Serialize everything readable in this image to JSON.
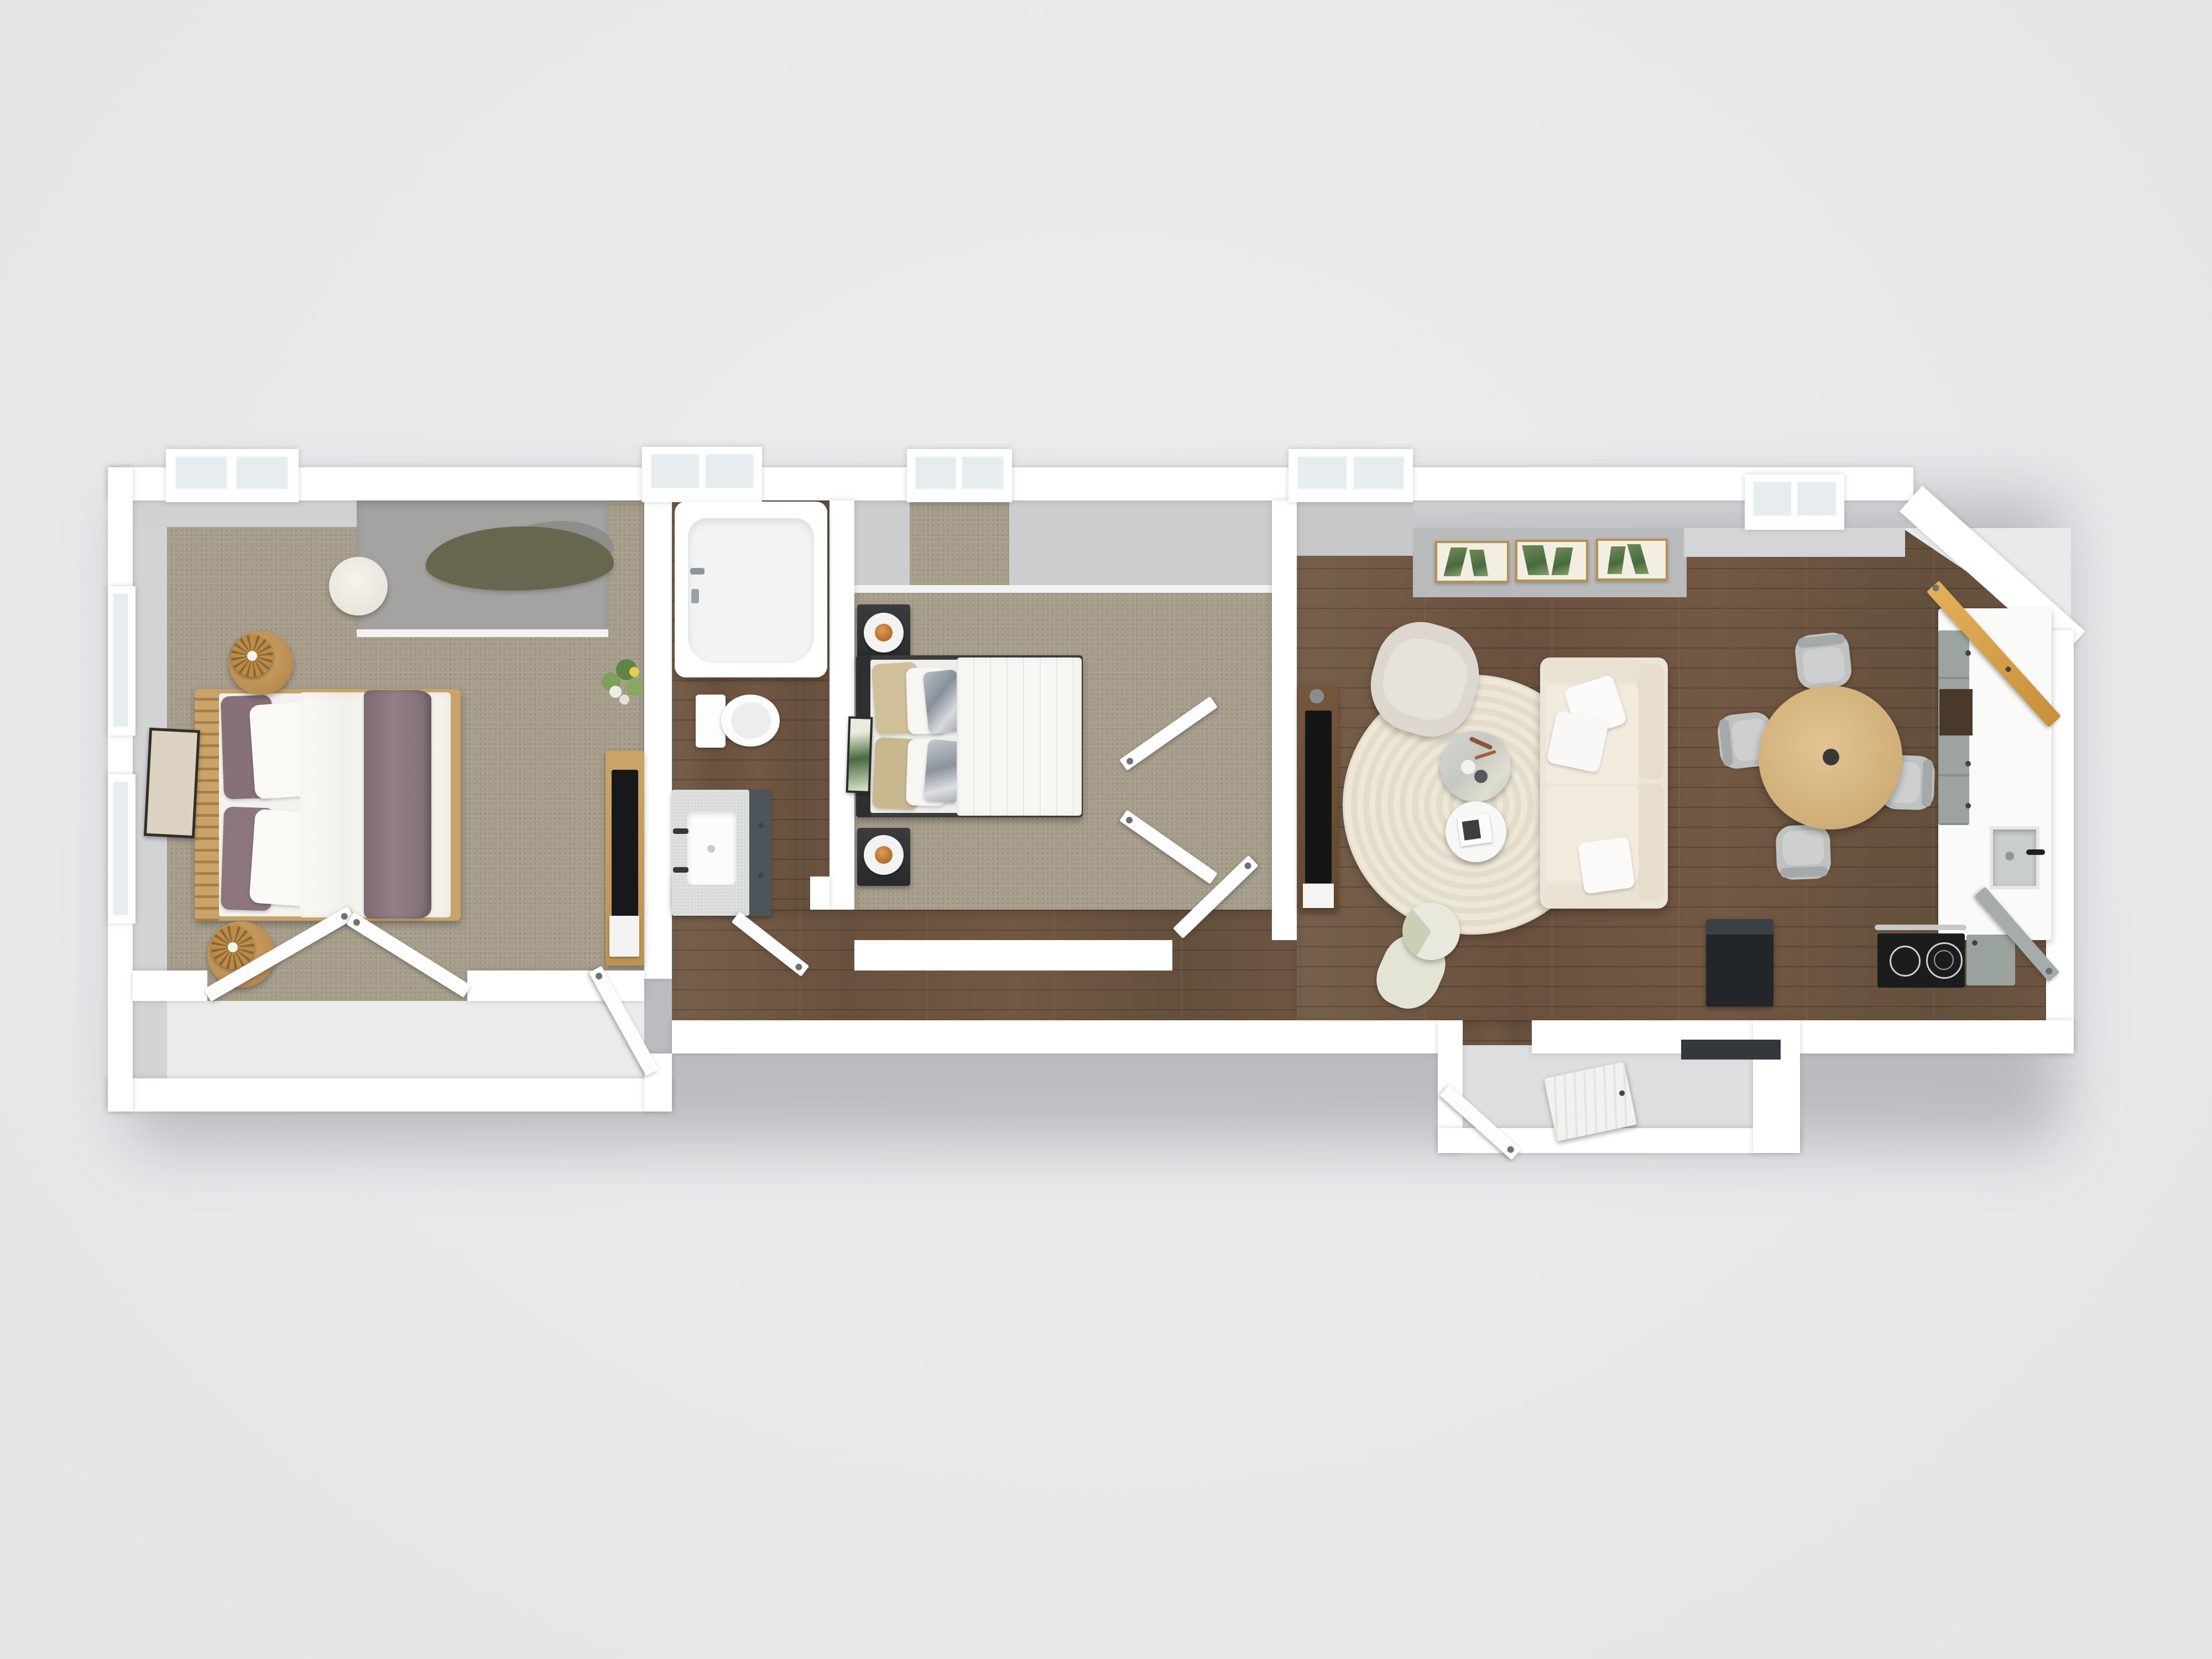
{
  "scene": {
    "description": "3D rendered top-down floor plan of a long, narrow two-bedroom apartment",
    "view": "top-down dollhouse render",
    "background_color": "#e9eaec",
    "wall_color": "#ffffff"
  },
  "rooms": [
    {
      "label": "Bedroom 1",
      "floor": "carpet",
      "items": [
        "oak double bed with white duvet and mauve throw",
        "two round oak nightstands with rattan lamps",
        "white round pouf",
        "organic olive-green rug in window nook",
        "leaning framed art",
        "oak dresser with TV, flowers and magazine",
        "closet with open double doors"
      ]
    },
    {
      "label": "Bathroom",
      "floor": "hardwood",
      "items": [
        "bathtub with chrome faucet",
        "toilet",
        "vanity with white sink and dark cabinet",
        "open door"
      ]
    },
    {
      "label": "Bedroom 2",
      "floor": "carpet",
      "items": [
        "black-frame double bed with quilted white duvet, khaki and marble pillows",
        "two black nightstands with bowl lamps",
        "leaning botanical art",
        "closet with open bifold doors",
        "open entry door"
      ]
    },
    {
      "label": "Hallway",
      "floor": "hardwood",
      "items": []
    },
    {
      "label": "Living room",
      "floor": "hardwood",
      "items": [
        "cream three-seat sofa with three white pillows",
        "round braided cream rug",
        "marble nesting coffee table with vase and sprigs",
        "white nesting coffee table with magazine",
        "cream armchair",
        "walnut media console with TV",
        "pouf with throw blanket",
        "gallery wall with three gold-framed botanical prints"
      ]
    },
    {
      "label": "Kitchen / dining",
      "floor": "hardwood",
      "items": [
        "round oak dining table",
        "four grey dining chairs",
        "white L-shaped counter with sage cabinets",
        "sink with black faucet",
        "black electric stove with two burners",
        "black refrigerator",
        "open amber wood door",
        "open grey door"
      ]
    },
    {
      "label": "Entry vestibule",
      "floor": "stone",
      "items": [
        "two open white doors",
        "dark door mat"
      ]
    }
  ],
  "palette": {
    "carpet": "#a69d8b",
    "hardwood": "#6f5541",
    "wall_face_grey": "#c9cbcd",
    "rug_cream": "#ece4d2",
    "sofa_cream": "#ece4d6",
    "bed1_throw_mauve": "#8b7880",
    "bed1_frame_oak": "#c9a369",
    "bed2_frame_black": "#3c3c3e",
    "pillow_khaki": "#cfc09a",
    "cabinet_sage": "#99a29c",
    "door_amber": "#d9a84e",
    "appliance_black": "#232629",
    "frame_gold": "#b5914f",
    "window_pane": "#e7ecef",
    "rug_olive": "#67664f"
  },
  "window_bays": 5,
  "open_doors": 10
}
